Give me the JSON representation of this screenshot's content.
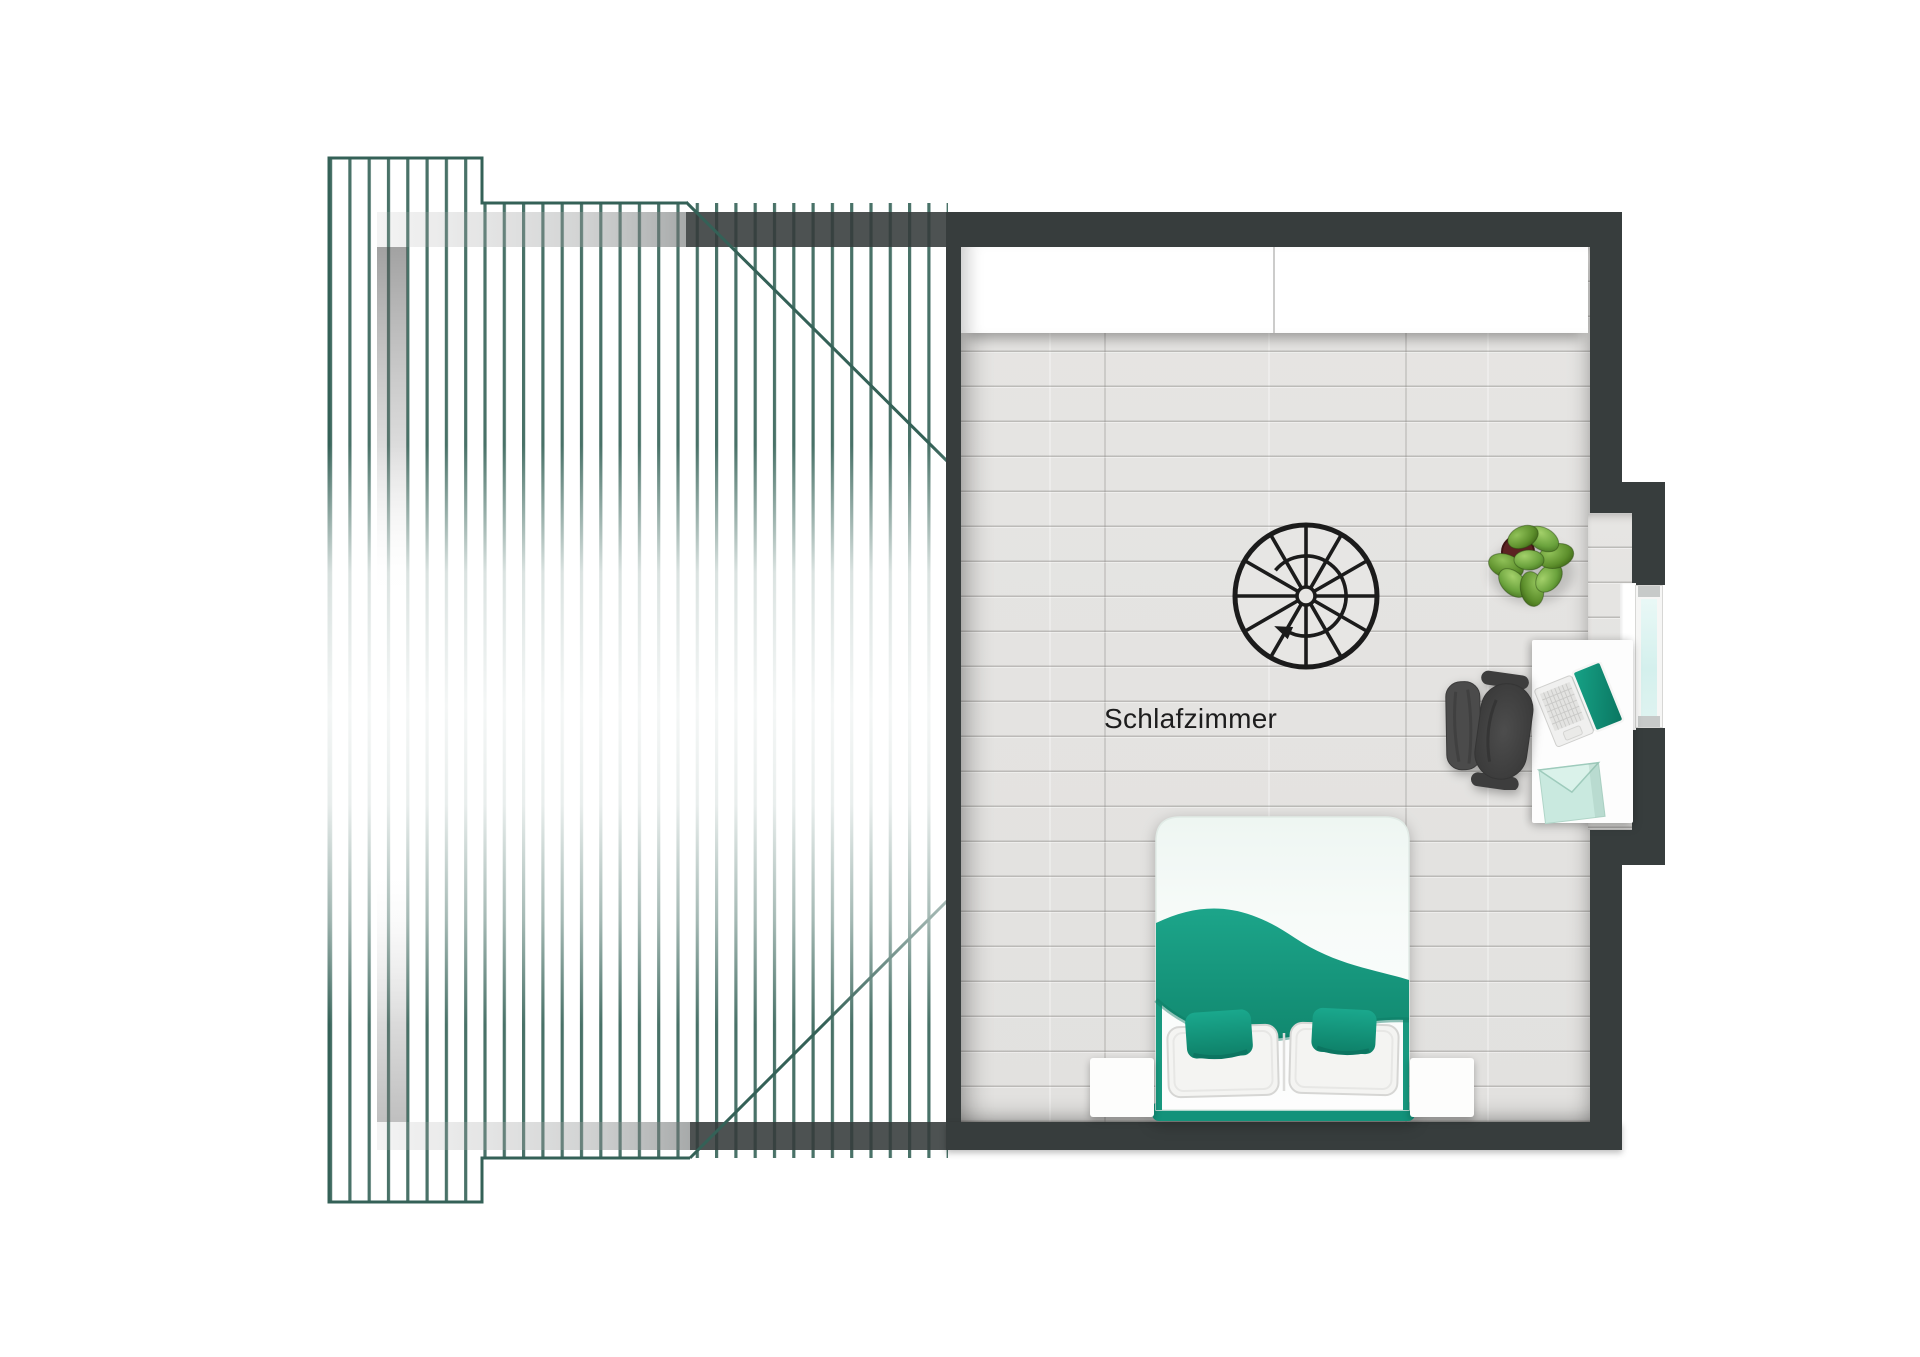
{
  "room": {
    "label": "Schlafzimmer"
  },
  "colors": {
    "wall": "#373d3d",
    "hatch_line": "#3f6b60",
    "accent_teal": "#189c82",
    "floor": "#e4e3e1",
    "window_glass": "#d9f1ee",
    "plant_green": "#6aa23c",
    "chair_gray": "#474747",
    "stair_symbol": "#1b1b1b",
    "text": "#1d1d1d"
  },
  "furniture": {
    "wardrobe": "wardrobe",
    "staircase": "spiral-staircase",
    "bed": "double-bed",
    "nightstand_left": "nightstand",
    "nightstand_right": "nightstand",
    "desk": "desk",
    "chair": "office-chair",
    "laptop": "laptop",
    "folder": "document-folder",
    "plant": "potted-plant",
    "window": "window"
  }
}
